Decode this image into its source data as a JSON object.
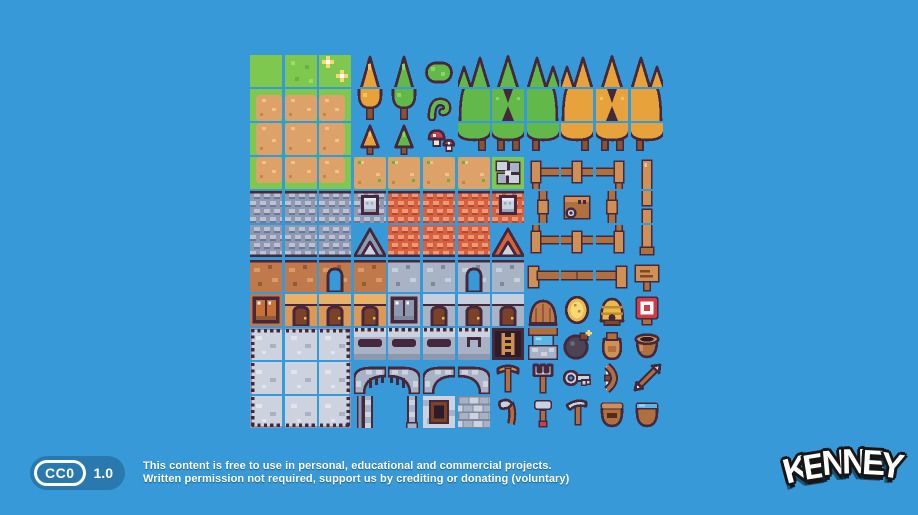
{
  "canvas": {
    "width": 918,
    "height": 515,
    "background_color": "#3799d8"
  },
  "license": {
    "badge_label": "CC0",
    "badge_version": "1.0",
    "badge_color": "#2a79ae",
    "line1": "This content is free to use in personal, educational and commercial projects.",
    "line2": "Written permission not required, support us by crediting or donating (voluntary)"
  },
  "logo": {
    "text": "KENNEY"
  },
  "palette": {
    "bg": "#3799d8",
    "outline": "#45283c",
    "grass": "#7ec850",
    "grassLight": "#9bdc66",
    "grassDark": "#63b243",
    "dirt": "#dca268",
    "dirtLight": "#eec190",
    "dirtDark": "#c08550",
    "trunk": "#8a5433",
    "foliageGreen": "#63b84a",
    "foliageGreenLight": "#8ad464",
    "foliageOrange": "#e8a23c",
    "foliageOrangeLight": "#f5c25e",
    "roofGray": "#8e98b0",
    "roofGrayLight": "#bac3d4",
    "roofGrayDark": "#6d7890",
    "roofRed": "#d6613f",
    "roofRedLight": "#ef9877",
    "roofRedDark": "#b34a32",
    "wallBrown": "#c0794a",
    "wallBrownLight": "#d89c68",
    "wallBrownDark": "#935b33",
    "wallGray": "#a9b3c6",
    "wallGrayLight": "#c6cfdd",
    "wallGrayDark": "#7e889c",
    "wallOrange": "#dd9858",
    "wallOrangeLight": "#eab269",
    "door": "#7b4227",
    "doorDark": "#532c1c",
    "stone": "#a8b2c6",
    "stoneLight": "#ccd3df",
    "stoneDark": "#8d97ad",
    "stoneXLight": "#e0e5ec",
    "wood": "#b06f3e",
    "woodLight": "#cf8f55",
    "woodDark": "#7c4a28",
    "gold": "#eab84c",
    "goldLight": "#f7d878",
    "goldDark": "#c08a2e",
    "red": "#d23c49",
    "white": "#ffffff",
    "water": "#55b8e8",
    "waterLight": "#9fd9f2",
    "metal": "#c9d2de",
    "metalDark": "#9aa5b8",
    "cream": "#efe6d4",
    "bomb": "#4c4454",
    "bombLight": "#746a84"
  },
  "tilesheet": {
    "columns": 12,
    "rows": 11,
    "tile_size": 32,
    "origin_x": 250,
    "origin_y": 55,
    "grid": [
      [
        "grass",
        "grass_detail",
        "grass_sparkle",
        "tree_orange_top",
        "tree_green_top",
        "bush_green",
        "grp_g_tl",
        "grp_g_tm",
        "grp_g_tr",
        "grp_o_tl",
        "grp_o_tm",
        "grp_o_tr"
      ],
      [
        "dirt_tl",
        "dirt_t",
        "dirt_tr",
        "tree_orange_bot",
        "tree_green_bot",
        "sprout",
        "grp_g_ml",
        "grp_g_mm",
        "grp_g_mr",
        "grp_o_ml",
        "grp_o_mm",
        "grp_o_mr"
      ],
      [
        "dirt_l",
        "dirt_c",
        "dirt_r",
        "tree_orange_small",
        "tree_green_small",
        "mushrooms",
        "grp_g_bl",
        "grp_g_bm",
        "grp_g_br",
        "grp_o_bl",
        "grp_o_bm",
        "grp_o_br"
      ],
      [
        "dirt_bl",
        "dirt_b",
        "dirt_br",
        "dirt_plain",
        "dirt_plain",
        "dirt_plain",
        "dirt_plain",
        "stones_grass",
        "fence_tl",
        "fence_tt",
        "fence_tr",
        "fence_v_top"
      ],
      [
        "roof_gray",
        "roof_gray",
        "roof_gray",
        "roof_gray_dormer",
        "roof_red",
        "roof_red",
        "roof_red",
        "roof_red_dormer",
        "fence_v",
        "chest",
        "fence_v",
        "fence_v_mid"
      ],
      [
        "roof_gray_bot",
        "roof_gray_bot",
        "roof_gray_bot",
        "gable_gray",
        "roof_red_bot",
        "roof_red_bot",
        "roof_red_bot",
        "gable_red",
        "fence_bl",
        "fence_tb",
        "fence_br",
        "fence_v_bot"
      ],
      [
        "wall_brown",
        "wall_brown",
        "wall_brown_arch",
        "wall_brown",
        "wall_gray",
        "wall_gray",
        "wall_gray_arch",
        "wall_gray",
        "log_l",
        "log_m",
        "log_r",
        "sign"
      ],
      [
        "window_brown",
        "wall_orange_door",
        "wall_orange_door",
        "wall_orange_door",
        "window_gray",
        "wall_gray_door",
        "wall_gray_door",
        "wall_gray_door",
        "well_top",
        "coin",
        "beehive",
        "target"
      ],
      [
        "floor_tl",
        "floor_t",
        "floor_tr",
        "battlement",
        "battlement",
        "battlement",
        "battlement_s",
        "ladder",
        "well_bot",
        "bomb",
        "sack",
        "pot"
      ],
      [
        "floor_l",
        "floor_c",
        "floor_r",
        "gate_l",
        "gate_r",
        "arch_l",
        "arch_r",
        "pickaxe",
        "pitchfork",
        "key",
        "bow",
        "arrow"
      ],
      [
        "floor_bl",
        "floor_b",
        "floor_br",
        "col_l",
        "col_r",
        "window_stone",
        "stone_bricks",
        "axe",
        "hammer",
        "scythe",
        "basket",
        "bucket_water"
      ]
    ]
  }
}
